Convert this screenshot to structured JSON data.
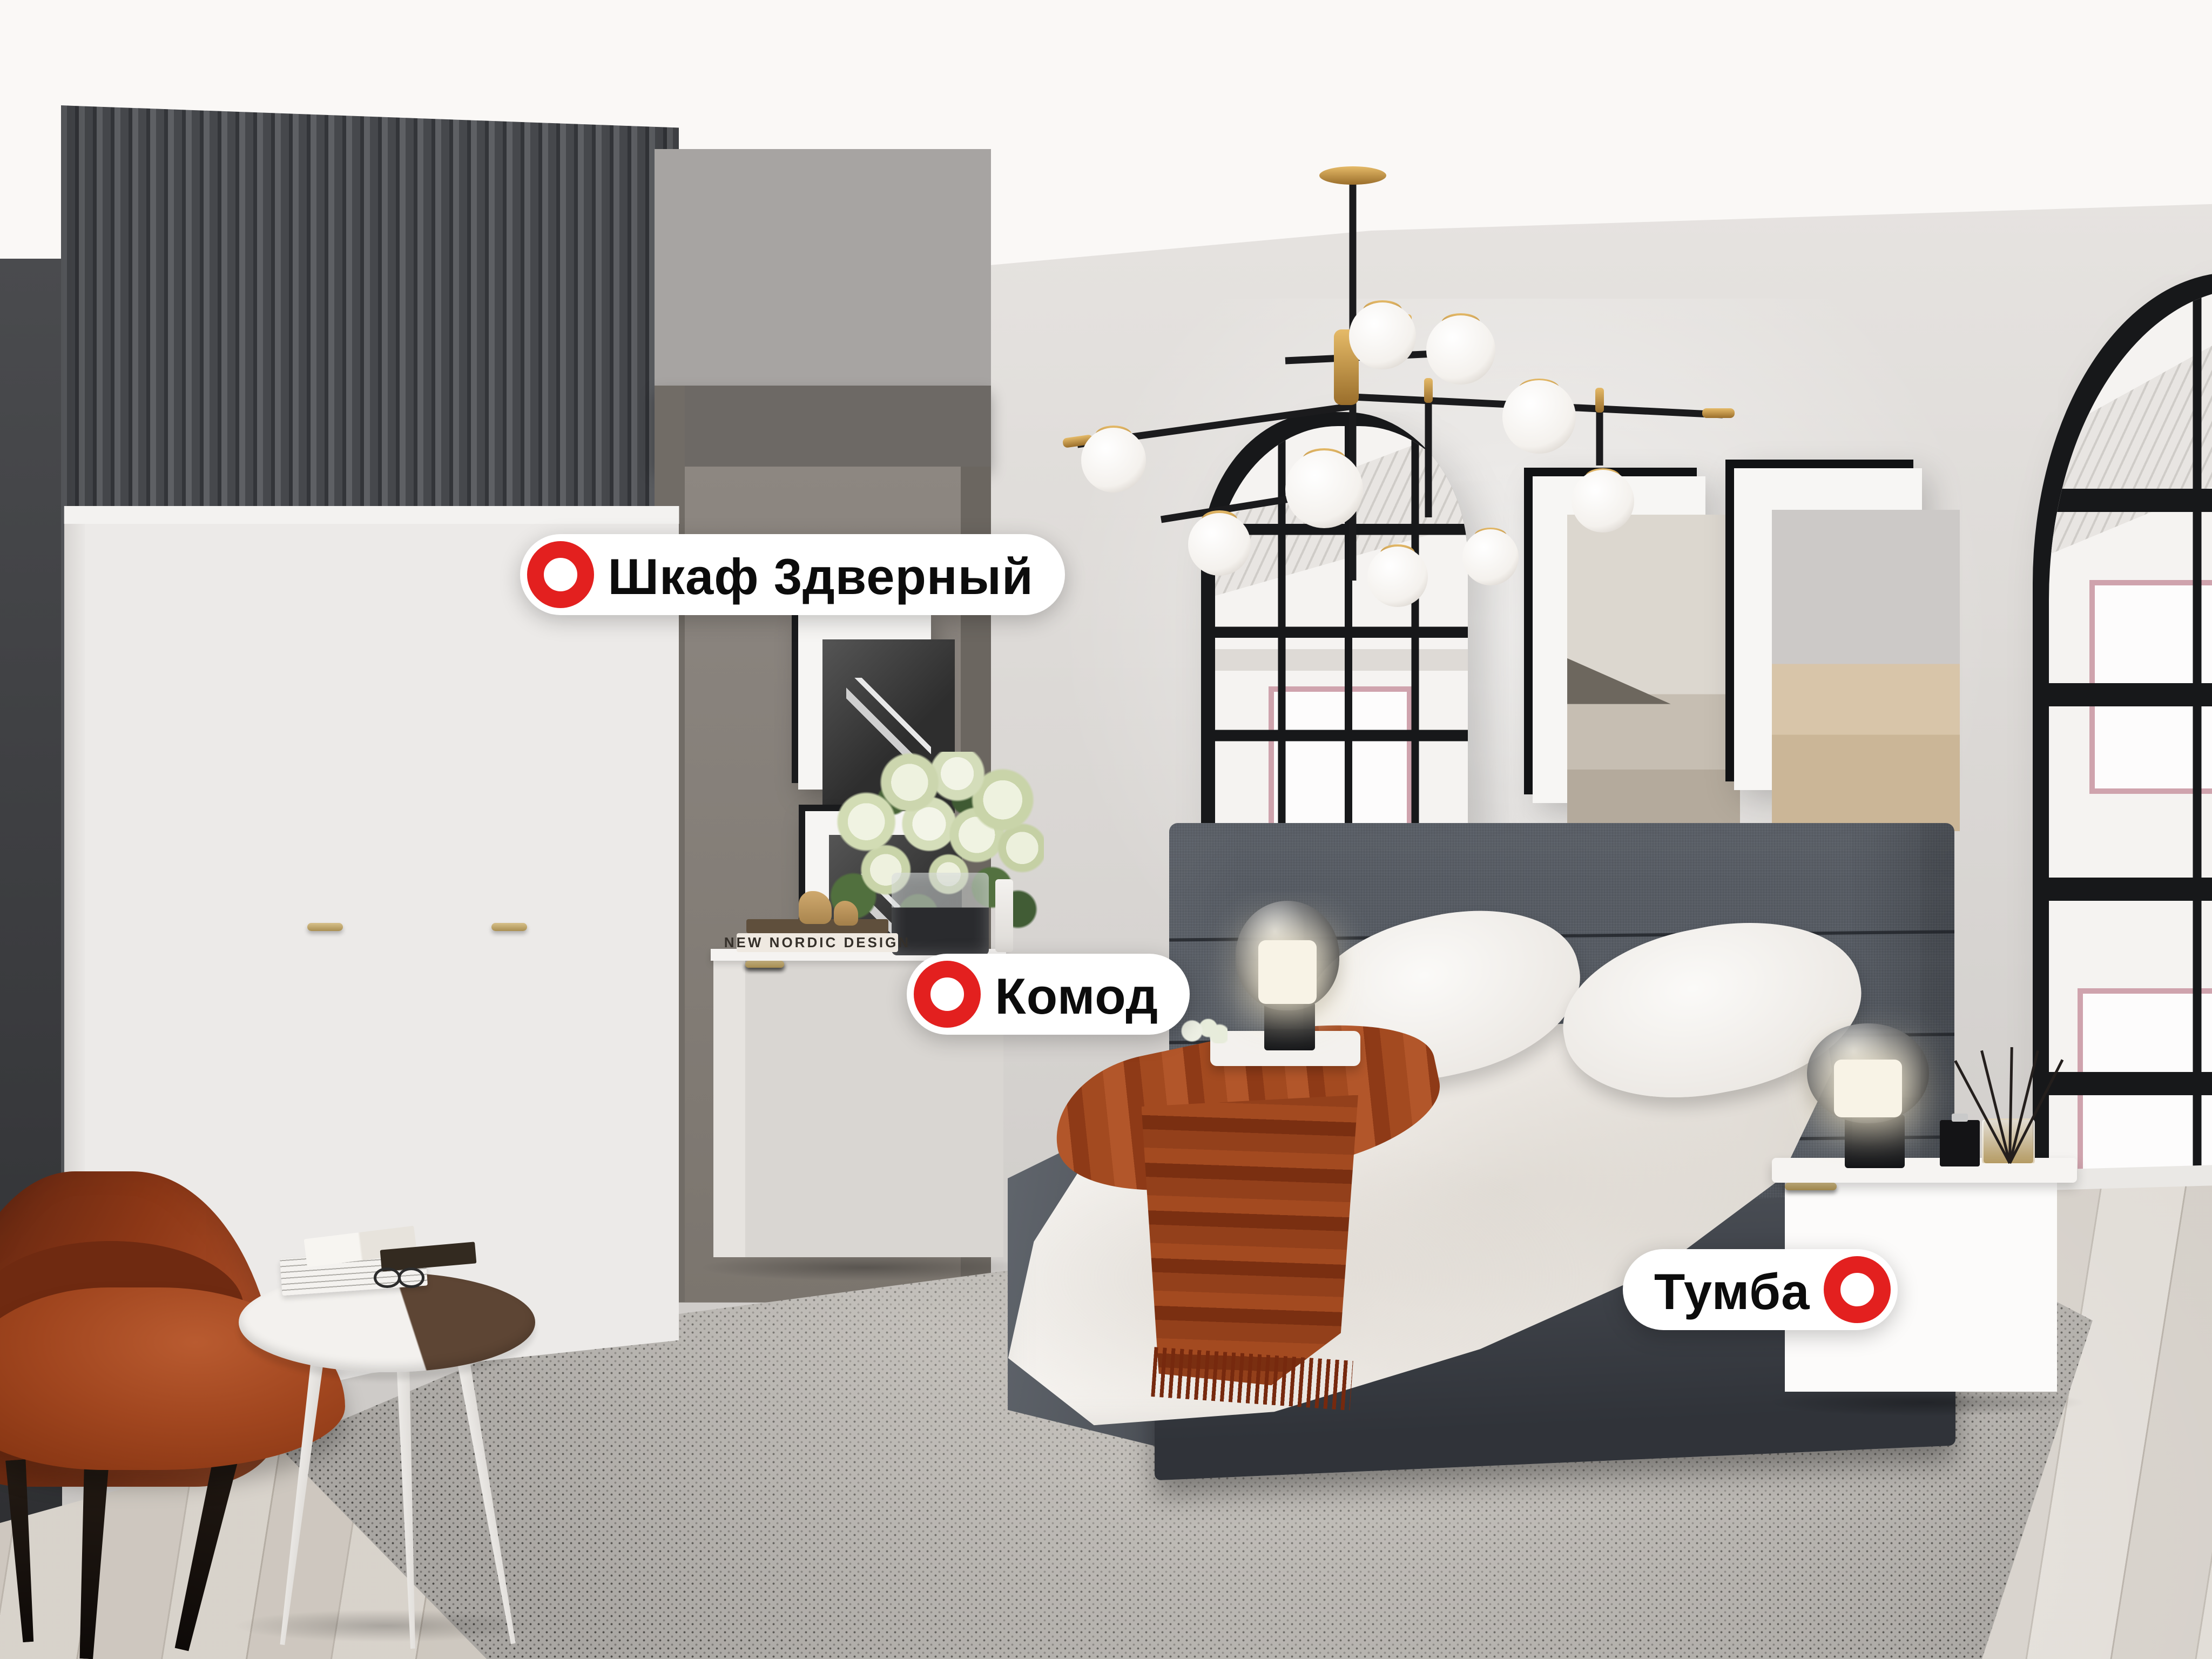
{
  "page": {
    "type": "furniture-showroom-photo",
    "room": "bedroom"
  },
  "hotspots": [
    {
      "id": "wardrobe",
      "label": "Шкаф 3дверный",
      "marker": "ring",
      "marker_side": "left"
    },
    {
      "id": "dresser",
      "label": "Комод",
      "marker": "ring",
      "marker_side": "left"
    },
    {
      "id": "nightstand",
      "label": "Тумба",
      "marker": "ring",
      "marker_side": "right"
    }
  ],
  "decor_text": {
    "book_spine": "NEW NORDIC DESIGN"
  },
  "colors": {
    "marker_red": "#E3201F",
    "label_bg": "#FFFFFF",
    "label_text": "#0C0C0C",
    "wall_light": "#DAD7D4",
    "accent_wall_dark": "#45474B",
    "headboard_gray": "#575C64",
    "throw_terracotta": "#A04620",
    "armchair_rust": "#9C3F1D",
    "gold": "#C79B4E"
  }
}
